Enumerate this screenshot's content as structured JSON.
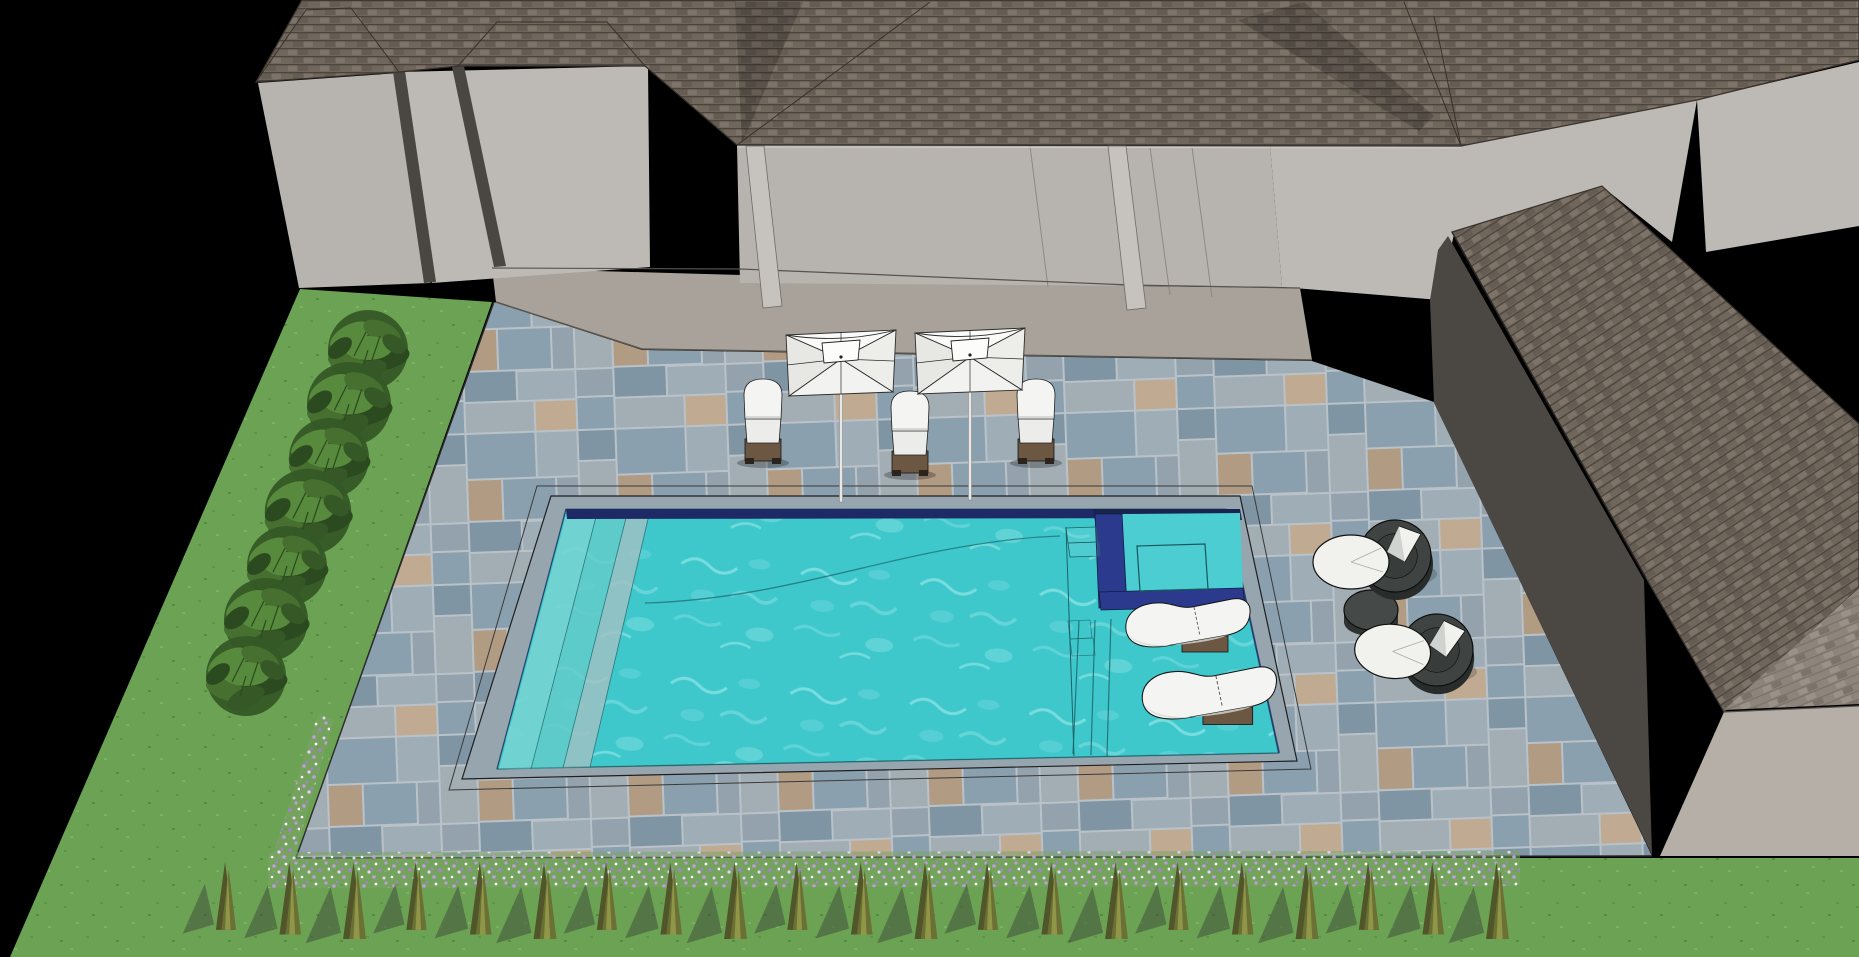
{
  "scene": {
    "description": "3D architectural rendering of a backyard swimming pool design with spa, tanning ledge, paver pool deck, lounge furniture, umbrellas and landscaping beside a gray hip-roof house on a black void background",
    "canvas": {
      "width": 1859,
      "height": 957
    },
    "colors": {
      "background": "#000000",
      "wall": "#b7b4b0",
      "wall_light": "#bdbab6",
      "wall_mid": "#b0ada9",
      "trim": "#4a4641",
      "column": "#c6c3bf",
      "wall_line": "#8c8883",
      "base_line": "#57524d",
      "roof": "#6f665c",
      "roof_line": "#4d453d",
      "roof_tab_light": "#7d7368",
      "roof_tab_dark": "#655c53",
      "roof_edge": "#38322c",
      "roof_light": "#8d857c",
      "roof_light_tab": "#9a9288",
      "roof_light_dark": "#7b7369",
      "wing_side": "#4b4743",
      "slab": "#a8a29b",
      "slab_edge": "#5a554f",
      "grout": "#b9c2c8",
      "paver1": "#8ba0ae",
      "paver2": "#9fadb6",
      "paver3": "#7f95a4",
      "paver4": "#a2adb4",
      "paver5": "#93a2ac",
      "paver_tan": "#b29b83",
      "paver_tan2": "#c0ab92",
      "coping": "#97a5ae",
      "joint_line": "#3a3a3a",
      "water": "#3fc8cc",
      "water_light": "#7fdde0",
      "water_pale": "#a9eeee",
      "spa_water": "#4bcdd1",
      "waterline_tile": "#1e2a66",
      "spa_tile": "#2c3a8e",
      "spa_tile_dark": "#18234f",
      "step_tread": "#76d4d2",
      "step_tread2": "#63cbc9",
      "step_riser": "#a3c0c2",
      "pool_line": "#1c6165",
      "lawn": "#6ba253",
      "lawn_dark": "#5d9546",
      "lawn_light": "#79b260",
      "lawn_deep": "#548c3e",
      "bush1": "#466f30",
      "bush2": "#355826",
      "bush3": "#578a3d",
      "bush4": "#2c4a1f",
      "flower1": "#c29ade",
      "flower2": "#a97fd0",
      "flower3": "#e6d4f4",
      "flower_white": "#ffffff",
      "grass_main": "#6b7034",
      "grass_dark": "#50552a",
      "grass_light": "#9aa04e",
      "grass_shadow": "#42503a",
      "umbrella_top": "#fafaf8",
      "umbrella_side": "#e7e7e4",
      "umbrella_side2": "#ededea",
      "umbrella_bottom": "#f2f2f0",
      "umbrella_line": "#2c2c2c",
      "pole": "#e8e8e6",
      "lounger_white": "#f4f4f2",
      "lounger_shade": "#d8d8d4",
      "lounger_base": "#6b5742",
      "lounger_foot": "#2c241c",
      "chair_ring": "#3f4442",
      "chair_ring_dark": "#282c2b",
      "chair_inner": "#383d3b",
      "cushion": "#f1f1ee",
      "cushion_shade": "#c9ccc8",
      "table_top": "#454a48",
      "table_side": "#2f3332",
      "outline": "#141414"
    },
    "objects": {
      "background": {
        "label": "black void background"
      },
      "lawn": {
        "label": "green lawn"
      },
      "house": {
        "label": "gray house with shingled hip roofs"
      },
      "covered_patio": {
        "label": "covered patio with columns"
      },
      "concrete_slab": {
        "label": "concrete slab walkway at house"
      },
      "paver_patio": {
        "label": "blue-gray stone paver pool deck"
      },
      "wing": {
        "label": "gabled roof wing at right"
      },
      "pool": {
        "label": "rectangular swimming pool with turquoise water"
      },
      "spa": {
        "label": "square spa inset in pool corner with navy tile border and bench"
      },
      "tanning_ledge": {
        "label": "tanning ledge with in-water loungers"
      },
      "pool_steps": {
        "label": "bench steps at far end and corner entry steps"
      },
      "umbrellas": {
        "label": "white square patio umbrella",
        "count": 2,
        "positions": [
          {
            "x": 786,
            "y": 330
          },
          {
            "x": 915,
            "y": 328
          }
        ]
      },
      "patio_loungers": {
        "label": "white chaise lounge on dark wood base",
        "count": 3,
        "positions": [
          {
            "x": 737,
            "y": 379
          },
          {
            "x": 884,
            "y": 391
          },
          {
            "x": 1010,
            "y": 379
          }
        ]
      },
      "ledge_loungers": {
        "label": "white contour lounger on tanning ledge",
        "count": 2,
        "positions": [
          {
            "x": 1120,
            "y": 596,
            "s": 1
          },
          {
            "x": 1136,
            "y": 664,
            "s": 1.08
          }
        ]
      },
      "round_chairs": {
        "label": "round charcoal wicker chair with white cushion",
        "count": 2,
        "positions": [
          {
            "x": 1395,
            "y": 556,
            "r": 0
          },
          {
            "x": 1437,
            "y": 650,
            "r": 6
          }
        ]
      },
      "side_table": {
        "label": "round charcoal side table",
        "count": 1,
        "position": {
          "x": 1371,
          "y": 610
        }
      },
      "shrubs": {
        "label": "row of green shrubs along west patio edge",
        "count": 7,
        "positions": [
          {
            "x": 368,
            "y": 350,
            "s": 1
          },
          {
            "x": 349,
            "y": 404,
            "s": 1.05
          },
          {
            "x": 329,
            "y": 458,
            "s": 1
          },
          {
            "x": 308,
            "y": 512,
            "s": 1.08
          },
          {
            "x": 287,
            "y": 566,
            "s": 1
          },
          {
            "x": 266,
            "y": 620,
            "s": 1.05
          },
          {
            "x": 246,
            "y": 676,
            "s": 1
          }
        ]
      },
      "grass_row": {
        "label": "row of ornamental grass tufts along lawn border",
        "count": 21,
        "x0": 214,
        "dx": 63.5,
        "y": 860
      },
      "flower_border": {
        "label": "purple flower groundcover border along patio edge"
      }
    }
  }
}
